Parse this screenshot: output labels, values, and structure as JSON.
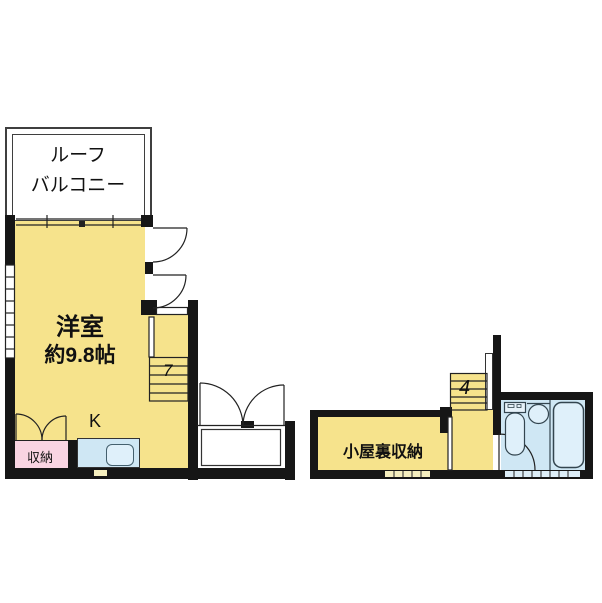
{
  "labels": {
    "roof_balcony_line1": "ルーフ",
    "roof_balcony_line2": "バルコニー",
    "main_room_name": "洋室",
    "main_room_size": "約9.8帖",
    "kitchen": "K",
    "closet": "収納",
    "attic_storage": "小屋裏収納",
    "stairs_main_mark": "7",
    "stairs_right_mark": "4"
  },
  "colors": {
    "room_fill": "#F6E38C",
    "closet_fill": "#F9D4E2",
    "water_fill": "#CFE7F4",
    "wall": "#161616",
    "balcony_outline": "#3f3f3f"
  }
}
